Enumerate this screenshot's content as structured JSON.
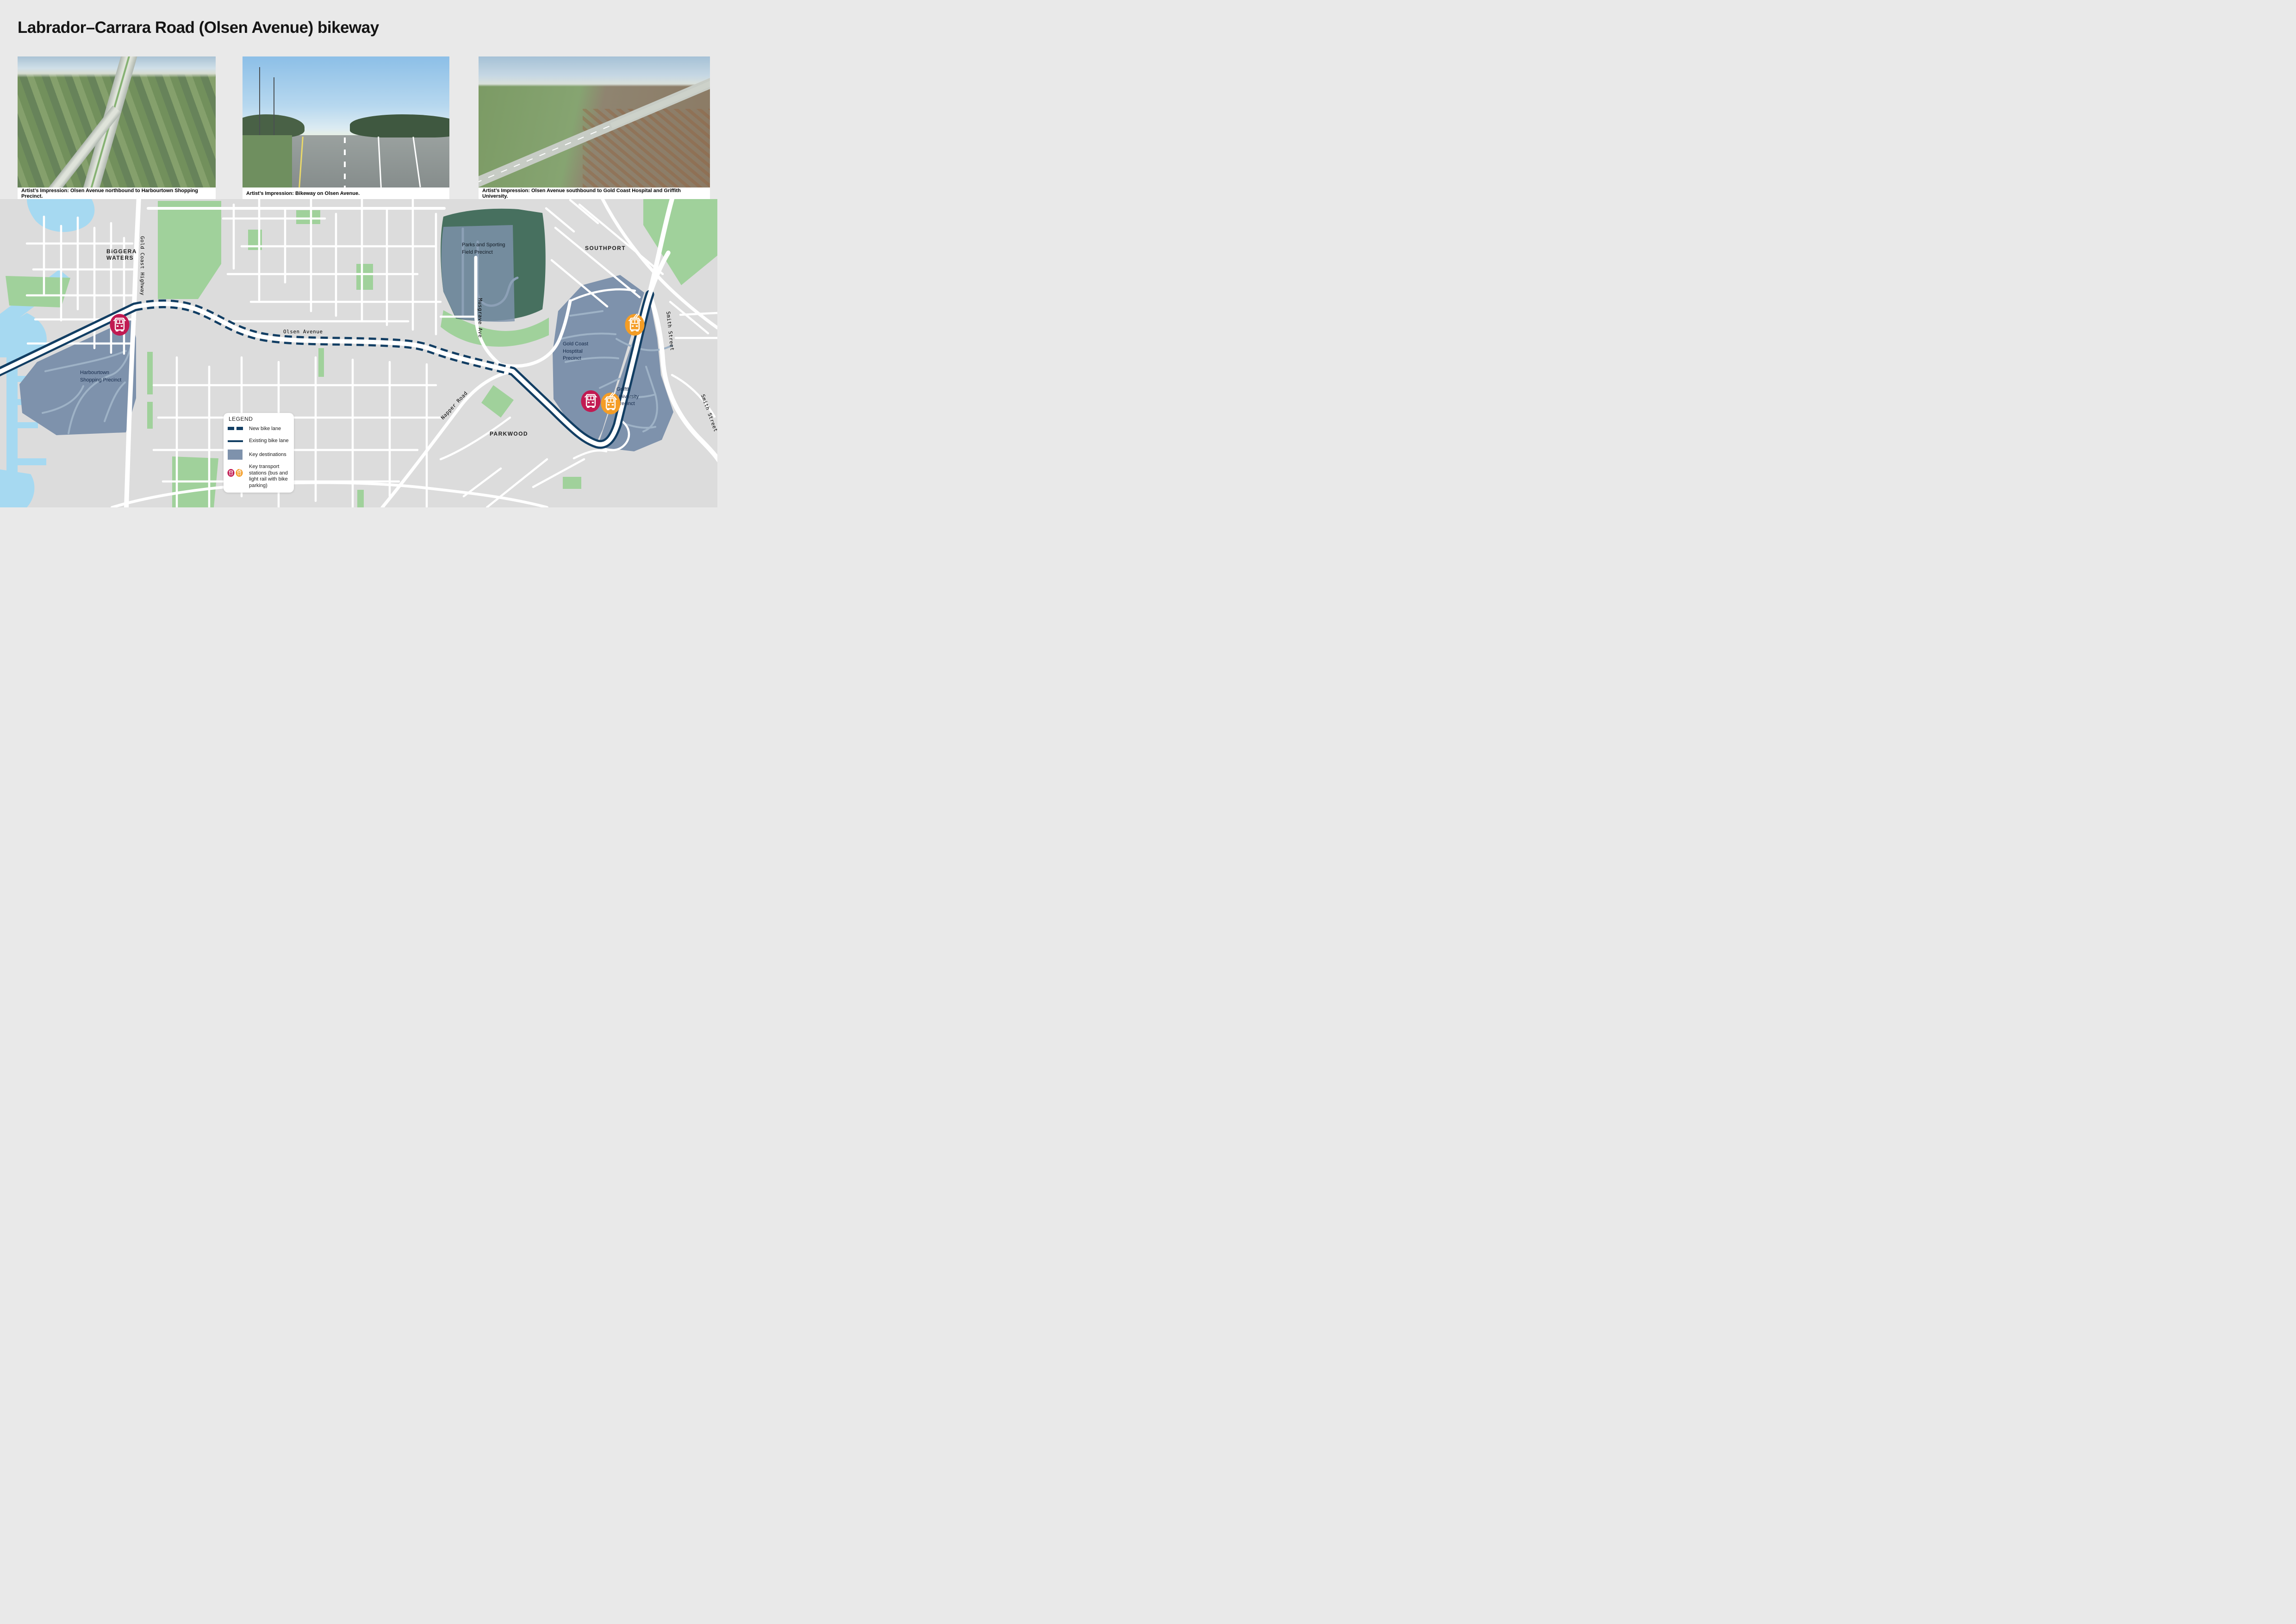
{
  "title": "Labrador–Carrara Road (Olsen Avenue) bikeway",
  "photos": [
    {
      "caption": "Artist’s Impression: Olsen Avenue northbound to Harbourtown Shopping Precinct."
    },
    {
      "caption": "Artist’s Impression: Bikeway on Olsen Avenue."
    },
    {
      "caption": "Artist’s Impression: Olsen Avenue southbound to Gold Coast Hospital and Griffith University."
    }
  ],
  "map": {
    "suburbs": {
      "biggera_waters": "BiGGERA WATERS",
      "southport": "SOUTHPORT",
      "parkwood": "PARKWOOD"
    },
    "roads": {
      "gold_coast_highway": "Gold Coast Highway",
      "olsen_avenue": "Olsen Avenue",
      "musgrave_ave": "Musgrave Ave",
      "napper_road": "Napper Road",
      "smith_street": "Smith Street"
    },
    "precincts": {
      "harbourtown": "Harbourtown Shopping Precinct",
      "parks": "Parks and Sporting Field Precinct",
      "hospital": "Gold Coast Hosptital Precinct",
      "griffith": "Griffth University Precinct"
    },
    "stations": [
      {
        "type": "bus"
      },
      {
        "type": "light-rail"
      },
      {
        "type": "bus"
      },
      {
        "type": "light-rail"
      }
    ]
  },
  "legend": {
    "title": "LEGEND",
    "new_bike_lane": "New bike lane",
    "existing_bike_lane": "Existing bike lane",
    "key_destinations": "Key destinations",
    "key_transport": "Key transport stations (bus and light rail with bike parking)"
  },
  "colors": {
    "bikeway_navy": "#123E63",
    "destination_slate": "#7E92AC",
    "station_bus_pink": "#C11A52",
    "station_rail_orange": "#F49D26",
    "park_green": "#A0D19B",
    "parks_precinct_green": "#47705F",
    "water_blue": "#A6D9F1",
    "map_background": "#DCDCDC"
  }
}
